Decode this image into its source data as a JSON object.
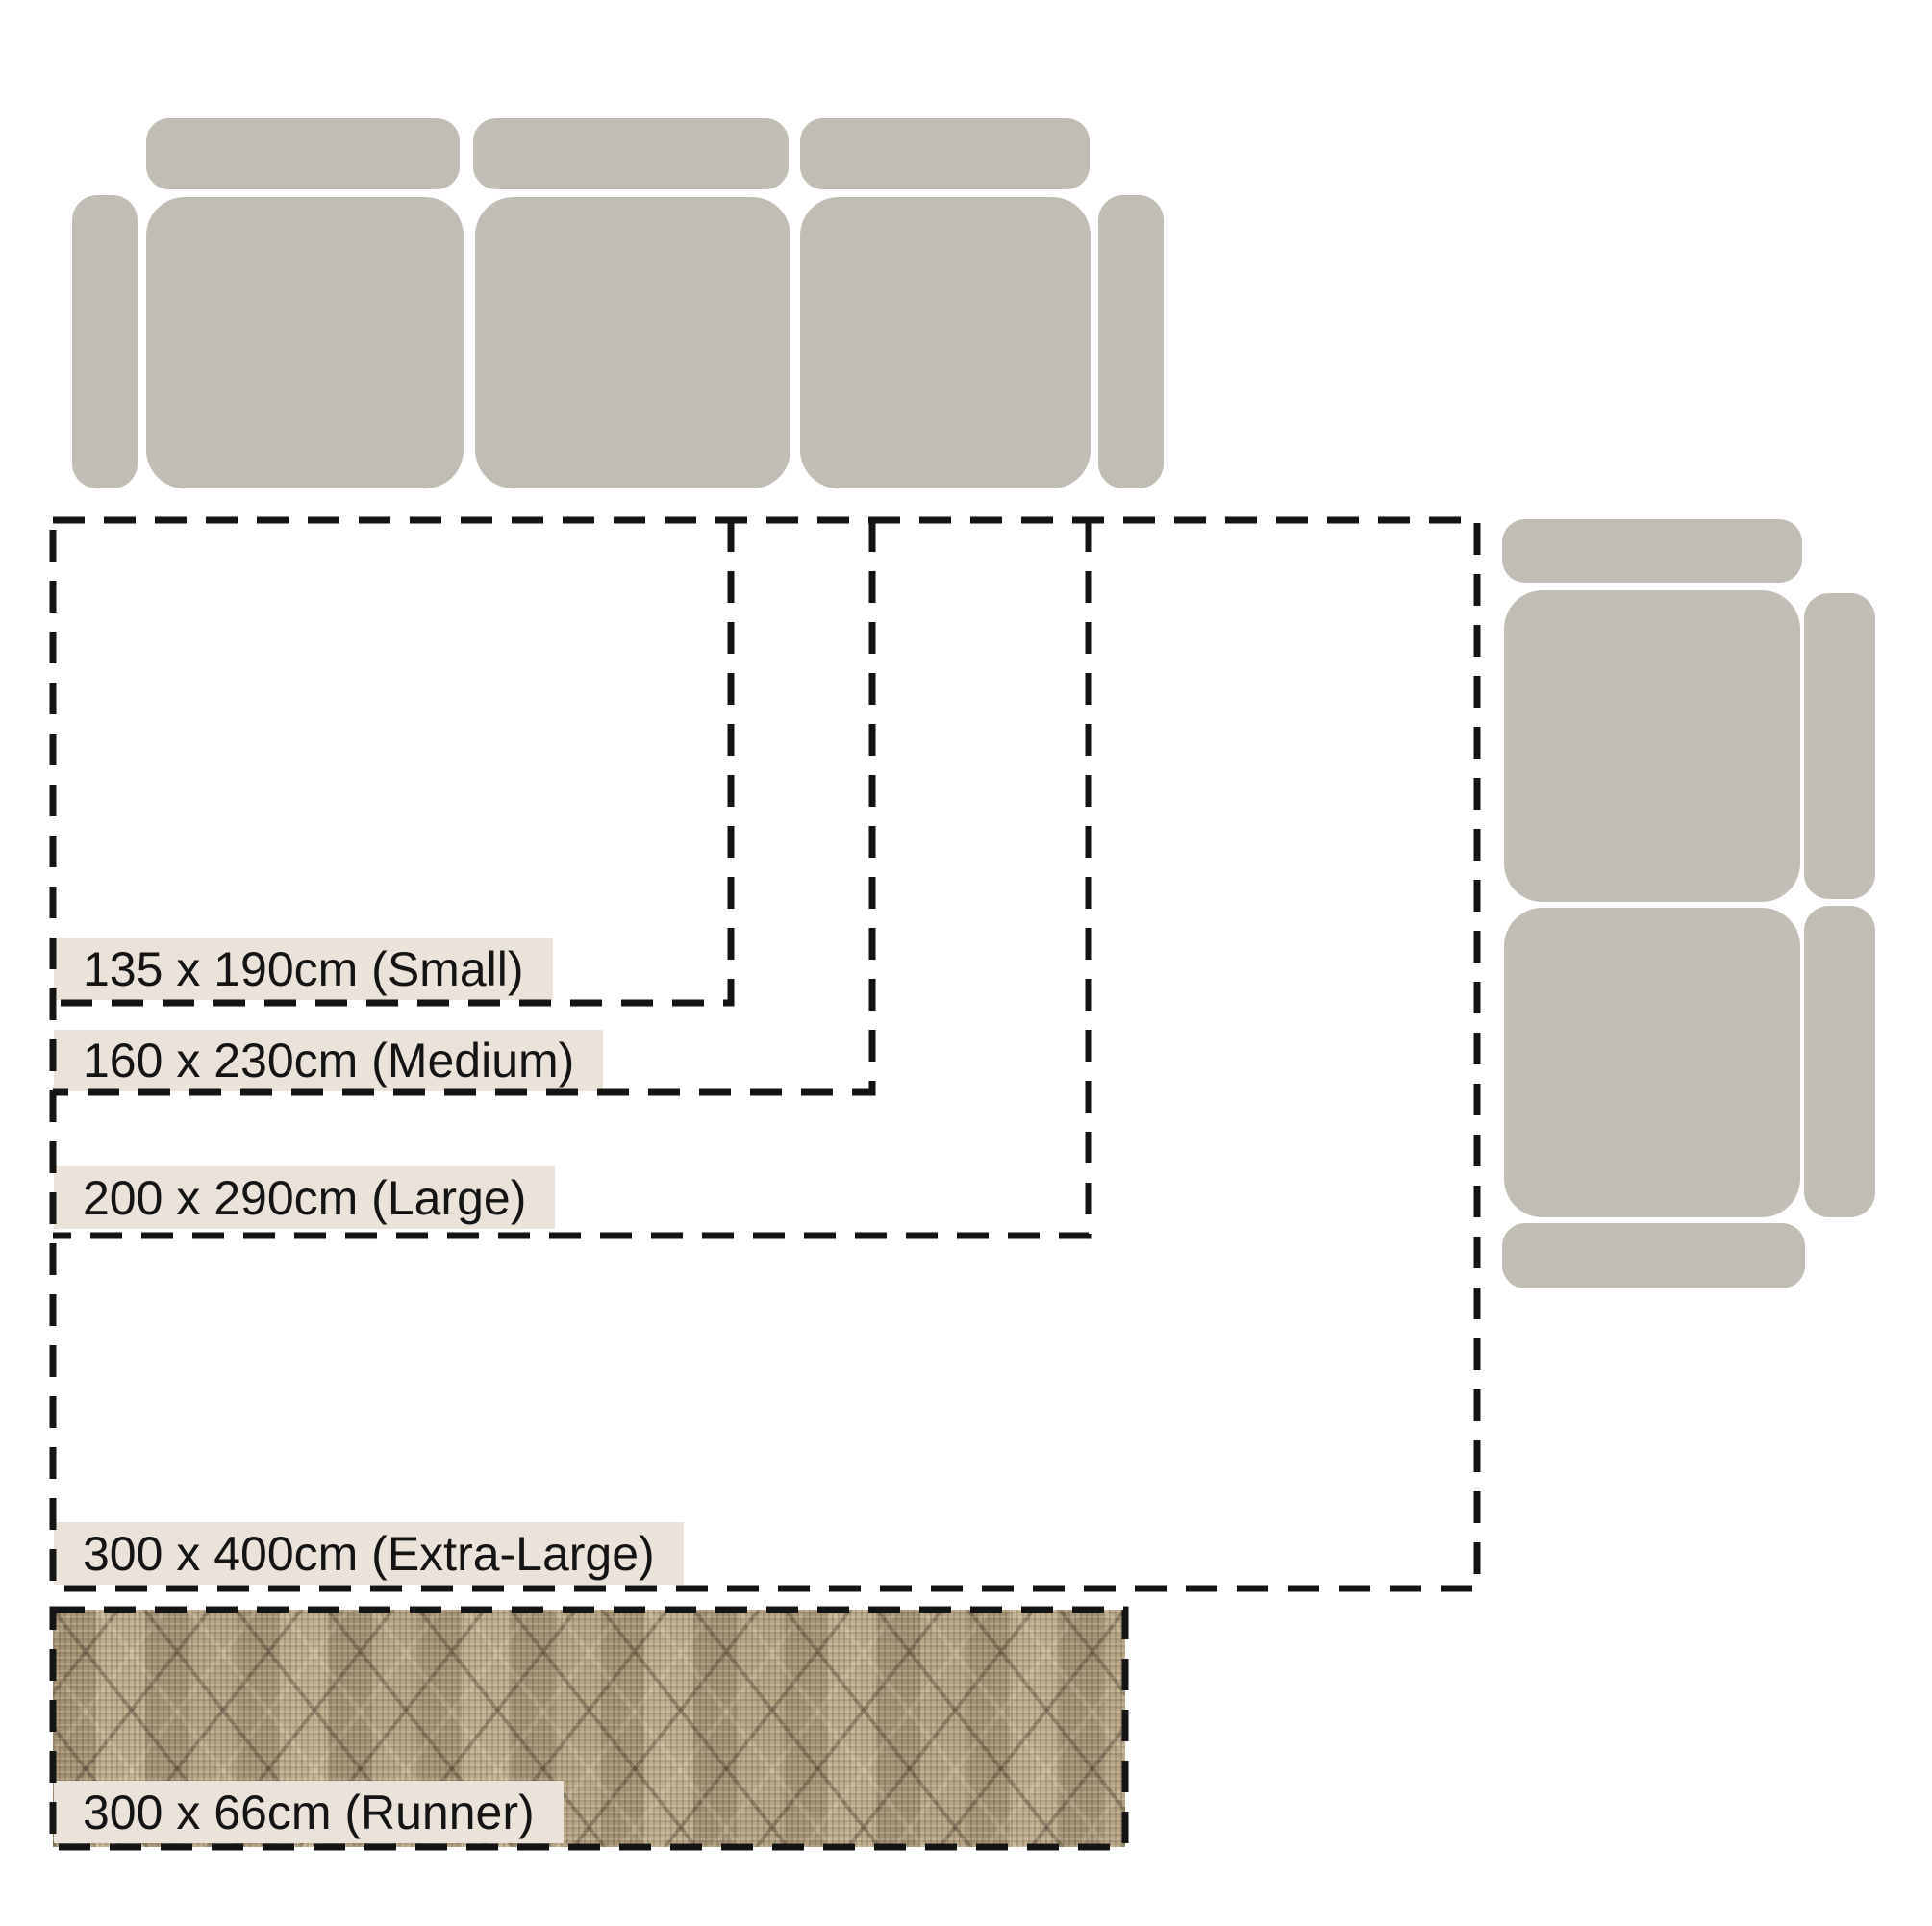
{
  "theme": {
    "page-bg": "#ffffff",
    "sofa-gray": "#c1bdb5",
    "dash-color": "#141414",
    "label-bg": "#ebe3d9",
    "label-text": "#141414",
    "runner-base": "#b3a181"
  },
  "diagram": {
    "rug_sizes": [
      {
        "id": "small",
        "label": "135 x 190cm (Small)"
      },
      {
        "id": "medium",
        "label": "160 x 230cm (Medium)"
      },
      {
        "id": "large",
        "label": "200 x 290cm (Large)"
      },
      {
        "id": "extra_large",
        "label": "300 x 400cm (Extra-Large)"
      },
      {
        "id": "runner",
        "label": "300 x 66cm (Runner)"
      }
    ],
    "icons": {
      "sofa_top": "three-seat-sofa-top-view",
      "sofa_right": "two-seat-sofa-top-view"
    }
  }
}
